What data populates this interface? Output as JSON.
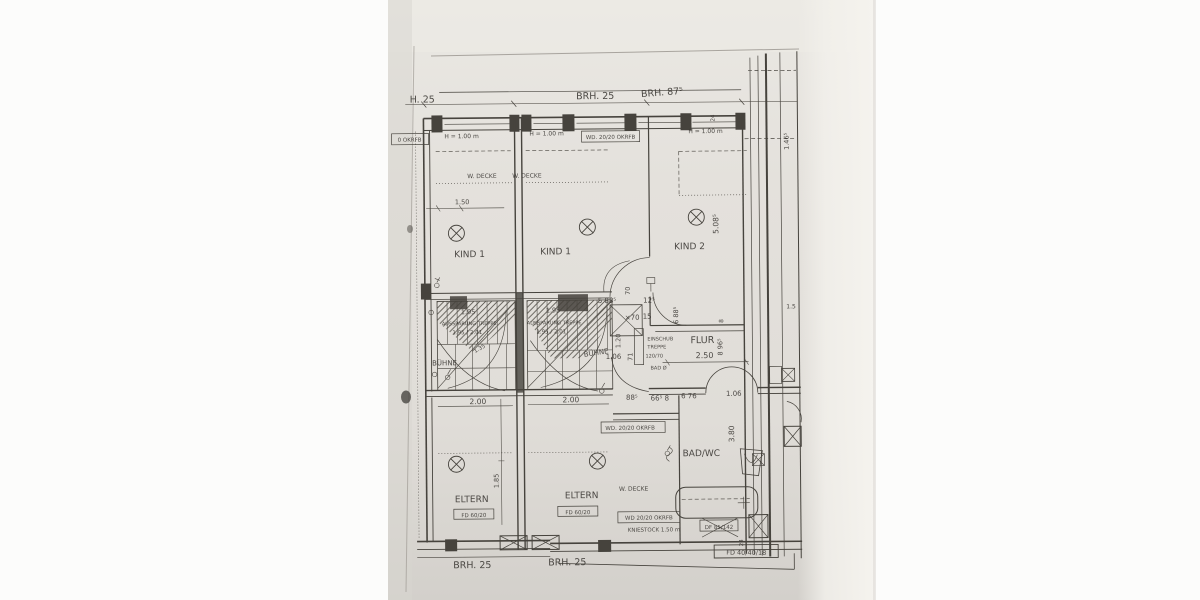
{
  "page": {
    "title": "1.DG:"
  },
  "colors": {
    "paper": "#e4e1dc",
    "ink": "#3f3c37"
  },
  "plan": {
    "rooms": {
      "kind1_left": "KIND 1",
      "kind1_mid": "KIND 1",
      "kind2": "KIND 2",
      "eltern_left": "ELTERN",
      "eltern_mid": "ELTERN",
      "bad_wc": "BAD/WC",
      "flur": "FLUR",
      "buehne_left": "BÜHNE",
      "buehne_mid": "BÜHNE"
    },
    "annotations": {
      "okrfb_left": "0 OKRFB",
      "h100_a": "H = 1.00 m",
      "h100_b": "H = 1.00 m",
      "h100_c": "H = 1.00 m",
      "wd2020_top": "WD. 20/20 OKRFB",
      "wdecke_a": "W. DECKE",
      "wdecke_b": "W. DECKE",
      "wdecke_c": "W. DECKE",
      "aussparung_a": "AUSSPARUNG TREPPE",
      "ratio_a": "1.95 / 2.01",
      "hatch_a": "1.95",
      "diag_a": "1.35",
      "aussparung_b": "AUSSPARUNG TREPPE",
      "ratio_b": "1.95 / 2.01",
      "hatch_b": "1.95",
      "einschub_l1": "EINSCHUB",
      "einschub_l2": "TREPPE",
      "einschub_l3": "120/70",
      "bad_door": "BAD Ø",
      "wd2020_mid": "WD. 20/20 OKRFB",
      "wd2020_bottom": "WD 20/20 OKRFB",
      "kniestock": "KNIESTOCK 1.50 m",
      "fd6020_a": "FD 60/20",
      "fd6020_b": "FD 60/20",
      "df85": "DF 85/142",
      "fd4040": "FD 40/40/18"
    },
    "dims": {
      "h25": "H. 25",
      "brh25_top": "BRH. 25",
      "brh875": "BRH. 87⁵",
      "d150": "1.50",
      "d15_right": "1.5",
      "d24_top": "24",
      "d508": "5.08⁵",
      "d146": "1.46⁵",
      "d70": "70",
      "d588": "5 88⁵",
      "dx70": "×70",
      "d125": "12⁵",
      "d15": "15",
      "d120": "1.20",
      "d106_hall": "1.06",
      "d71": "71",
      "d688": "6 88⁵",
      "d8": "8",
      "d965": "8 96⁵",
      "d250": "2.50",
      "d380": "3.80",
      "d200_a": "2.00",
      "d200_b": "2.00",
      "d885": "88⁵",
      "d665": "66⁵ 8",
      "d676": "6 76",
      "d106_bad": "1.06",
      "d185": "1.85",
      "d24_bottom": "24",
      "brh25_bottom_a": "BRH. 25",
      "brh25_bottom_b": "BRH. 25"
    }
  }
}
